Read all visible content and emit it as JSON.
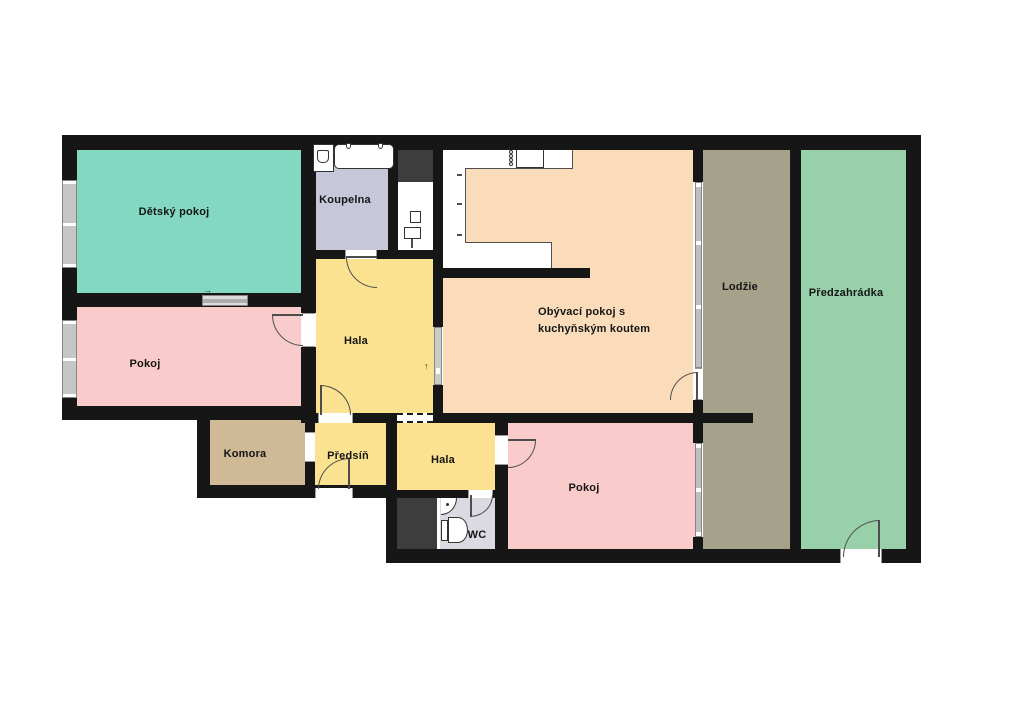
{
  "type": "floor-plan",
  "language": "cs",
  "rooms": [
    {
      "key": "detsky_pokoj",
      "label": "Dětský pokoj"
    },
    {
      "key": "koupelna",
      "label": "Koupelna"
    },
    {
      "key": "pokoj_left",
      "label": "Pokoj"
    },
    {
      "key": "hala_upper",
      "label": "Hala"
    },
    {
      "key": "komora",
      "label": "Komora"
    },
    {
      "key": "predsin",
      "label": "Předsíň"
    },
    {
      "key": "hala_lower",
      "label": "Hala"
    },
    {
      "key": "wc",
      "label": "WC"
    },
    {
      "key": "obyvaci_pokoj",
      "label": "Obývací pokoj s kuchyňským koutem"
    },
    {
      "key": "pokoj_bottom",
      "label": "Pokoj"
    },
    {
      "key": "lodzie",
      "label": "Lodžie"
    },
    {
      "key": "predzahradka",
      "label": "Předzahrádka"
    }
  ],
  "colors": {
    "wall": "#161616",
    "detsky_pokoj": "#82d8c0",
    "koupelna": "#c6c7d9",
    "hala": "#fbe290",
    "pokoj": "#f9cbca",
    "komora": "#cfb996",
    "obyvaci": "#fbdcba",
    "lodzie": "#a5a18b",
    "predzahradka": "#98d1a9",
    "wc_floor": "#dadae3",
    "shaft": "#3d3d3d",
    "window": "#c6c6c6"
  },
  "annotations": {
    "arrow_right": "→",
    "arrow_up": "↑"
  }
}
